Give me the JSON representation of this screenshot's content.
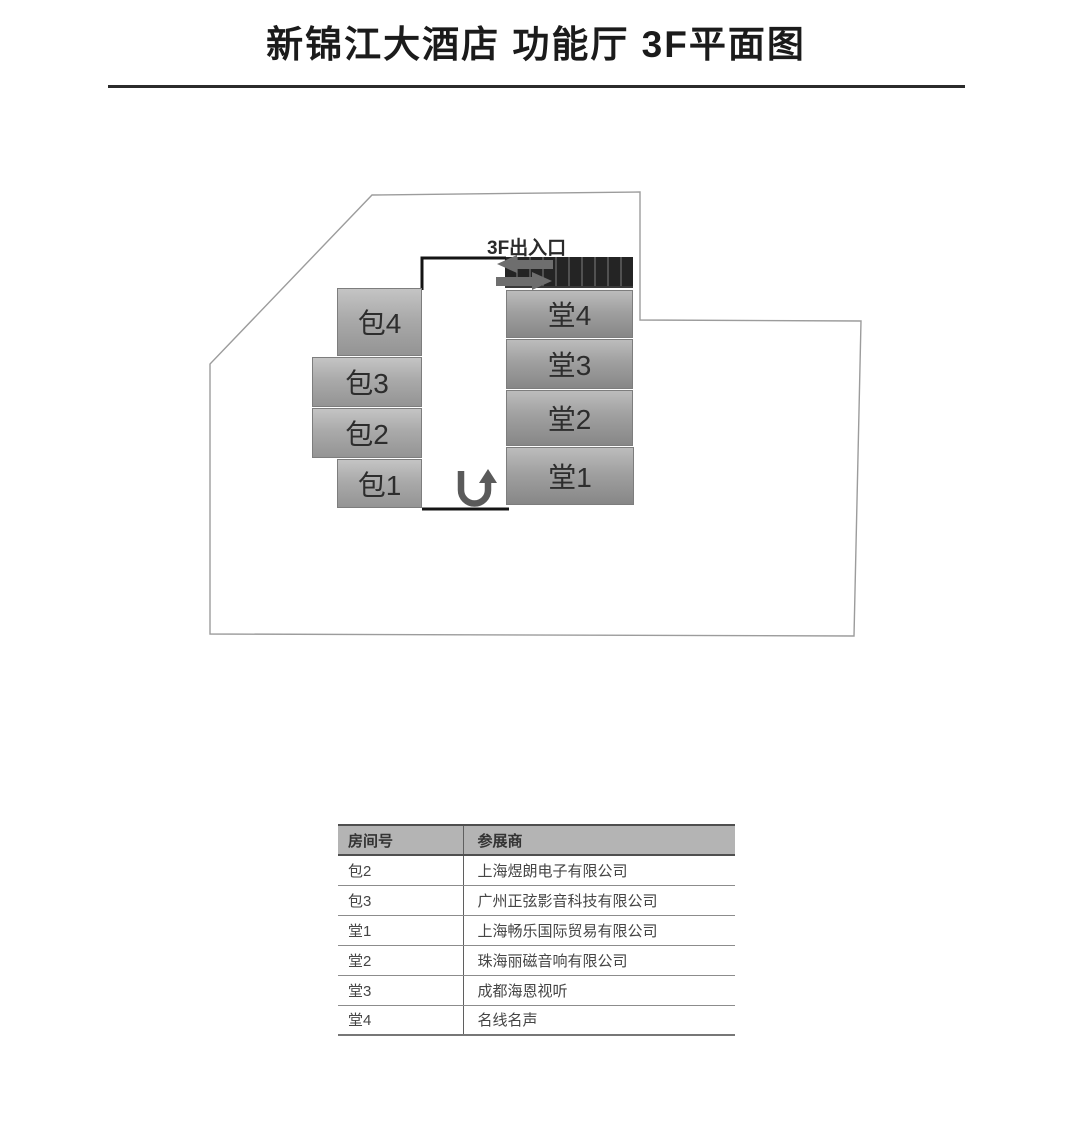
{
  "title": "新锦江大酒店 功能厅 3F平面图",
  "plan": {
    "entrance_label": "3F出入口",
    "left_rooms": [
      "包4",
      "包3",
      "包2",
      "包1"
    ],
    "right_rooms": [
      "堂4",
      "堂3",
      "堂2",
      "堂1"
    ],
    "icons": {
      "entry_arrow": "arrow-left",
      "exit_arrow": "arrow-right",
      "turnaround": "u-turn-arrow",
      "stairs": "stairs-hatch"
    },
    "colors": {
      "room_fill_light": "#c4c4c4",
      "room_fill_dark": "#878787",
      "stairs_dark": "#242424",
      "corridor_wall": "#141414",
      "building_outline": "#9c9c9c"
    }
  },
  "table": {
    "headers": [
      "房间号",
      "参展商"
    ],
    "rows": [
      {
        "room": "包2",
        "exhibitor": "上海煜朗电子有限公司"
      },
      {
        "room": "包3",
        "exhibitor": "广州正弦影音科技有限公司"
      },
      {
        "room": "堂1",
        "exhibitor": "上海畅乐国际贸易有限公司"
      },
      {
        "room": "堂2",
        "exhibitor": "珠海丽磁音响有限公司"
      },
      {
        "room": "堂3",
        "exhibitor": "成都海恩视听"
      },
      {
        "room": "堂4",
        "exhibitor": "名线名声"
      }
    ]
  }
}
